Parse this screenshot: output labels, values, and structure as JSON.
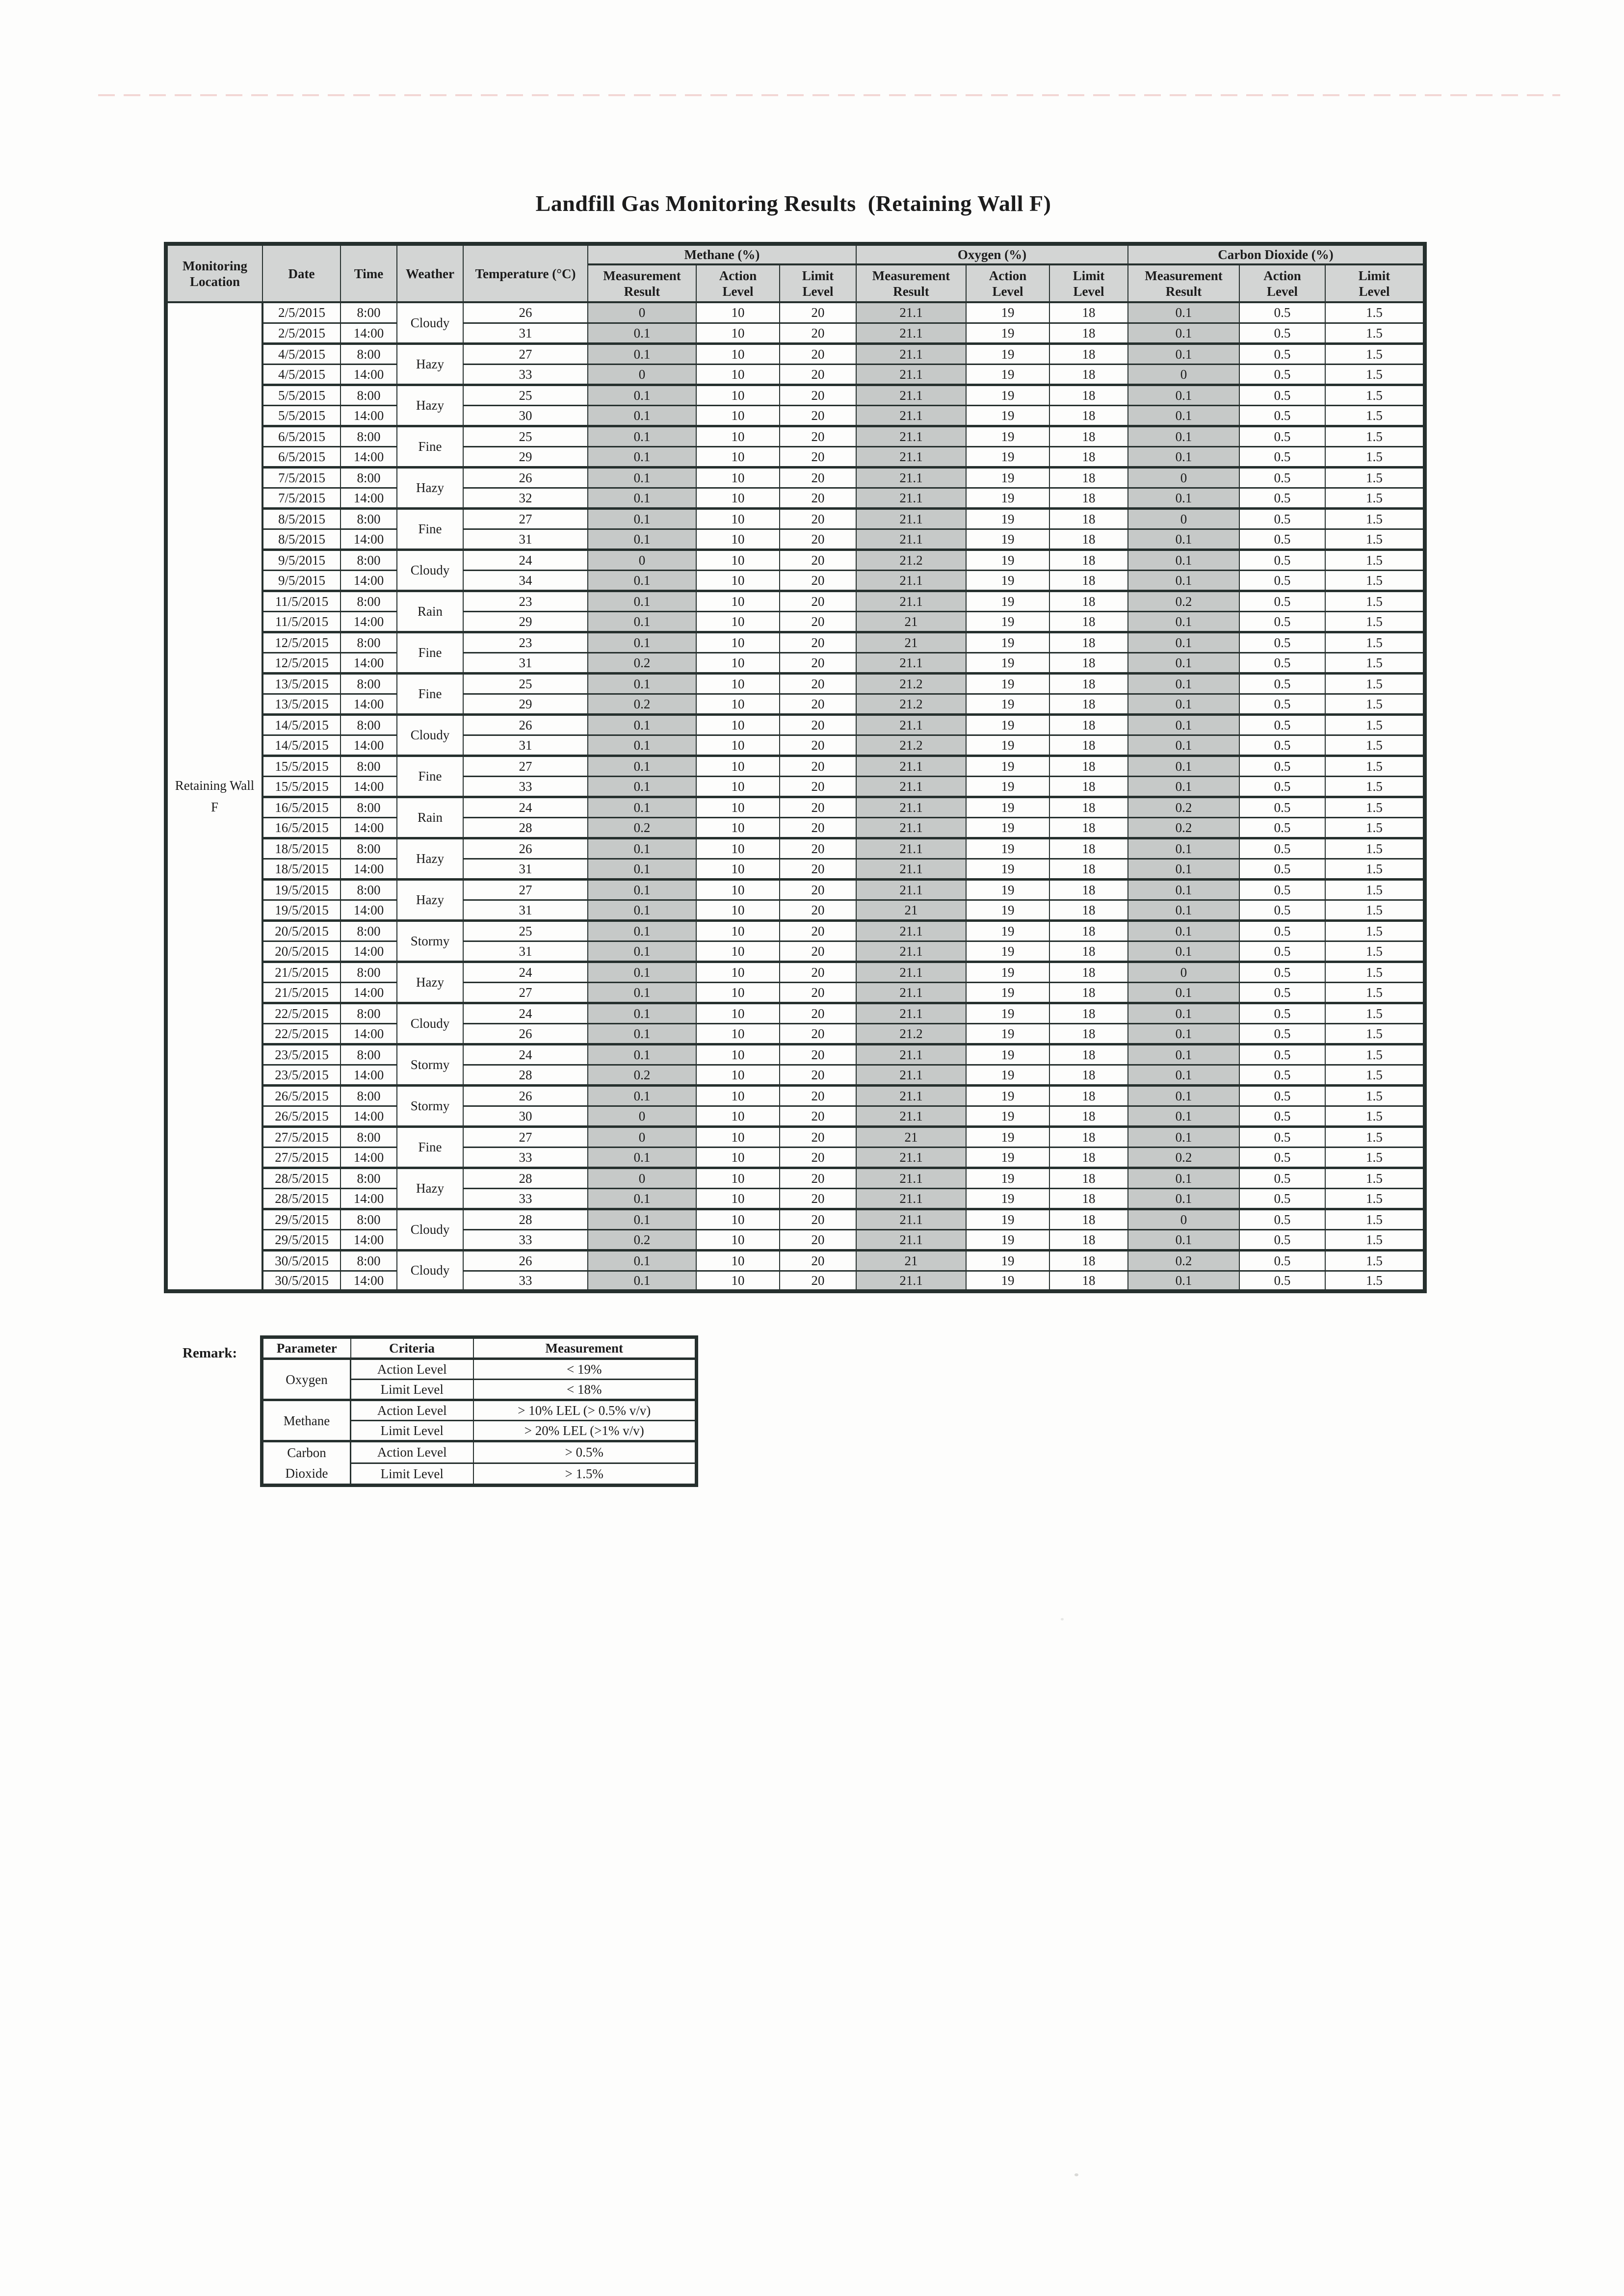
{
  "page": {
    "title": "Landfill Gas Monitoring Results  (Retaining Wall F)"
  },
  "colors": {
    "paper": "#fdfdfc",
    "ink": "#1c1c1c",
    "line": "#26302e",
    "cell_shade": "#c6c9c8",
    "header_shade": "#d3d5d4"
  },
  "table": {
    "location_label": "Retaining Wall\nF",
    "headers": {
      "location": "Monitoring\nLocation",
      "date": "Date",
      "time": "Time",
      "weather": "Weather",
      "temperature": "Temperature (°C)",
      "methane_group": "Methane (%)",
      "oxygen_group": "Oxygen (%)",
      "co2_group": "Carbon Dioxide (%)",
      "sub": [
        "Measurement\nResult",
        "Action\nLevel",
        "Limit\nLevel"
      ]
    },
    "constants": {
      "methane_action": "10",
      "methane_limit": "20",
      "oxygen_action": "19",
      "oxygen_limit": "18",
      "co2_action": "0.5",
      "co2_limit": "1.5"
    },
    "days": [
      {
        "date": "2/5/2015",
        "weather": "Cloudy",
        "entries": [
          {
            "time": "8:00",
            "temp": "26",
            "ch4": "0",
            "o2": "21.1",
            "co2": "0.1"
          },
          {
            "time": "14:00",
            "temp": "31",
            "ch4": "0.1",
            "o2": "21.1",
            "co2": "0.1"
          }
        ]
      },
      {
        "date": "4/5/2015",
        "weather": "Hazy",
        "entries": [
          {
            "time": "8:00",
            "temp": "27",
            "ch4": "0.1",
            "o2": "21.1",
            "co2": "0.1"
          },
          {
            "time": "14:00",
            "temp": "33",
            "ch4": "0",
            "o2": "21.1",
            "co2": "0"
          }
        ]
      },
      {
        "date": "5/5/2015",
        "weather": "Hazy",
        "entries": [
          {
            "time": "8:00",
            "temp": "25",
            "ch4": "0.1",
            "o2": "21.1",
            "co2": "0.1"
          },
          {
            "time": "14:00",
            "temp": "30",
            "ch4": "0.1",
            "o2": "21.1",
            "co2": "0.1"
          }
        ]
      },
      {
        "date": "6/5/2015",
        "weather": "Fine",
        "entries": [
          {
            "time": "8:00",
            "temp": "25",
            "ch4": "0.1",
            "o2": "21.1",
            "co2": "0.1"
          },
          {
            "time": "14:00",
            "temp": "29",
            "ch4": "0.1",
            "o2": "21.1",
            "co2": "0.1"
          }
        ]
      },
      {
        "date": "7/5/2015",
        "weather": "Hazy",
        "entries": [
          {
            "time": "8:00",
            "temp": "26",
            "ch4": "0.1",
            "o2": "21.1",
            "co2": "0"
          },
          {
            "time": "14:00",
            "temp": "32",
            "ch4": "0.1",
            "o2": "21.1",
            "co2": "0.1"
          }
        ]
      },
      {
        "date": "8/5/2015",
        "weather": "Fine",
        "entries": [
          {
            "time": "8:00",
            "temp": "27",
            "ch4": "0.1",
            "o2": "21.1",
            "co2": "0"
          },
          {
            "time": "14:00",
            "temp": "31",
            "ch4": "0.1",
            "o2": "21.1",
            "co2": "0.1"
          }
        ]
      },
      {
        "date": "9/5/2015",
        "weather": "Cloudy",
        "entries": [
          {
            "time": "8:00",
            "temp": "24",
            "ch4": "0",
            "o2": "21.2",
            "co2": "0.1"
          },
          {
            "time": "14:00",
            "temp": "34",
            "ch4": "0.1",
            "o2": "21.1",
            "co2": "0.1"
          }
        ]
      },
      {
        "date": "11/5/2015",
        "weather": "Rain",
        "entries": [
          {
            "time": "8:00",
            "temp": "23",
            "ch4": "0.1",
            "o2": "21.1",
            "co2": "0.2"
          },
          {
            "time": "14:00",
            "temp": "29",
            "ch4": "0.1",
            "o2": "21",
            "co2": "0.1"
          }
        ]
      },
      {
        "date": "12/5/2015",
        "weather": "Fine",
        "entries": [
          {
            "time": "8:00",
            "temp": "23",
            "ch4": "0.1",
            "o2": "21",
            "co2": "0.1"
          },
          {
            "time": "14:00",
            "temp": "31",
            "ch4": "0.2",
            "o2": "21.1",
            "co2": "0.1"
          }
        ]
      },
      {
        "date": "13/5/2015",
        "weather": "Fine",
        "entries": [
          {
            "time": "8:00",
            "temp": "25",
            "ch4": "0.1",
            "o2": "21.2",
            "co2": "0.1"
          },
          {
            "time": "14:00",
            "temp": "29",
            "ch4": "0.2",
            "o2": "21.2",
            "co2": "0.1"
          }
        ]
      },
      {
        "date": "14/5/2015",
        "weather": "Cloudy",
        "entries": [
          {
            "time": "8:00",
            "temp": "26",
            "ch4": "0.1",
            "o2": "21.1",
            "co2": "0.1"
          },
          {
            "time": "14:00",
            "temp": "31",
            "ch4": "0.1",
            "o2": "21.2",
            "co2": "0.1"
          }
        ]
      },
      {
        "date": "15/5/2015",
        "weather": "Fine",
        "entries": [
          {
            "time": "8:00",
            "temp": "27",
            "ch4": "0.1",
            "o2": "21.1",
            "co2": "0.1"
          },
          {
            "time": "14:00",
            "temp": "33",
            "ch4": "0.1",
            "o2": "21.1",
            "co2": "0.1"
          }
        ]
      },
      {
        "date": "16/5/2015",
        "weather": "Rain",
        "entries": [
          {
            "time": "8:00",
            "temp": "24",
            "ch4": "0.1",
            "o2": "21.1",
            "co2": "0.2"
          },
          {
            "time": "14:00",
            "temp": "28",
            "ch4": "0.2",
            "o2": "21.1",
            "co2": "0.2"
          }
        ]
      },
      {
        "date": "18/5/2015",
        "weather": "Hazy",
        "entries": [
          {
            "time": "8:00",
            "temp": "26",
            "ch4": "0.1",
            "o2": "21.1",
            "co2": "0.1"
          },
          {
            "time": "14:00",
            "temp": "31",
            "ch4": "0.1",
            "o2": "21.1",
            "co2": "0.1"
          }
        ]
      },
      {
        "date": "19/5/2015",
        "weather": "Hazy",
        "entries": [
          {
            "time": "8:00",
            "temp": "27",
            "ch4": "0.1",
            "o2": "21.1",
            "co2": "0.1"
          },
          {
            "time": "14:00",
            "temp": "31",
            "ch4": "0.1",
            "o2": "21",
            "co2": "0.1"
          }
        ]
      },
      {
        "date": "20/5/2015",
        "weather": "Stormy",
        "entries": [
          {
            "time": "8:00",
            "temp": "25",
            "ch4": "0.1",
            "o2": "21.1",
            "co2": "0.1"
          },
          {
            "time": "14:00",
            "temp": "31",
            "ch4": "0.1",
            "o2": "21.1",
            "co2": "0.1"
          }
        ]
      },
      {
        "date": "21/5/2015",
        "weather": "Hazy",
        "entries": [
          {
            "time": "8:00",
            "temp": "24",
            "ch4": "0.1",
            "o2": "21.1",
            "co2": "0"
          },
          {
            "time": "14:00",
            "temp": "27",
            "ch4": "0.1",
            "o2": "21.1",
            "co2": "0.1"
          }
        ]
      },
      {
        "date": "22/5/2015",
        "weather": "Cloudy",
        "entries": [
          {
            "time": "8:00",
            "temp": "24",
            "ch4": "0.1",
            "o2": "21.1",
            "co2": "0.1"
          },
          {
            "time": "14:00",
            "temp": "26",
            "ch4": "0.1",
            "o2": "21.2",
            "co2": "0.1"
          }
        ]
      },
      {
        "date": "23/5/2015",
        "weather": "Stormy",
        "entries": [
          {
            "time": "8:00",
            "temp": "24",
            "ch4": "0.1",
            "o2": "21.1",
            "co2": "0.1"
          },
          {
            "time": "14:00",
            "temp": "28",
            "ch4": "0.2",
            "o2": "21.1",
            "co2": "0.1"
          }
        ]
      },
      {
        "date": "26/5/2015",
        "weather": "Stormy",
        "entries": [
          {
            "time": "8:00",
            "temp": "26",
            "ch4": "0.1",
            "o2": "21.1",
            "co2": "0.1"
          },
          {
            "time": "14:00",
            "temp": "30",
            "ch4": "0",
            "o2": "21.1",
            "co2": "0.1"
          }
        ]
      },
      {
        "date": "27/5/2015",
        "weather": "Fine",
        "entries": [
          {
            "time": "8:00",
            "temp": "27",
            "ch4": "0",
            "o2": "21",
            "co2": "0.1"
          },
          {
            "time": "14:00",
            "temp": "33",
            "ch4": "0.1",
            "o2": "21.1",
            "co2": "0.2"
          }
        ]
      },
      {
        "date": "28/5/2015",
        "weather": "Hazy",
        "entries": [
          {
            "time": "8:00",
            "temp": "28",
            "ch4": "0",
            "o2": "21.1",
            "co2": "0.1"
          },
          {
            "time": "14:00",
            "temp": "33",
            "ch4": "0.1",
            "o2": "21.1",
            "co2": "0.1"
          }
        ]
      },
      {
        "date": "29/5/2015",
        "weather": "Cloudy",
        "entries": [
          {
            "time": "8:00",
            "temp": "28",
            "ch4": "0.1",
            "o2": "21.1",
            "co2": "0"
          },
          {
            "time": "14:00",
            "temp": "33",
            "ch4": "0.2",
            "o2": "21.1",
            "co2": "0.1"
          }
        ]
      },
      {
        "date": "30/5/2015",
        "weather": "Cloudy",
        "entries": [
          {
            "time": "8:00",
            "temp": "26",
            "ch4": "0.1",
            "o2": "21",
            "co2": "0.2"
          },
          {
            "time": "14:00",
            "temp": "33",
            "ch4": "0.1",
            "o2": "21.1",
            "co2": "0.1"
          }
        ]
      }
    ]
  },
  "remark": {
    "label": "Remark:",
    "headers": {
      "parameter": "Parameter",
      "criteria": "Criteria",
      "measurement": "Measurement"
    },
    "groups": [
      {
        "name": "Oxygen",
        "rows": [
          {
            "criteria": "Action Level",
            "measurement": "< 19%"
          },
          {
            "criteria": "Limit Level",
            "measurement": "< 18%"
          }
        ]
      },
      {
        "name": "Methane",
        "rows": [
          {
            "criteria": "Action Level",
            "measurement": "> 10% LEL (> 0.5% v/v)"
          },
          {
            "criteria": "Limit Level",
            "measurement": "> 20% LEL (>1% v/v)"
          }
        ]
      },
      {
        "name": "Carbon\nDioxide",
        "rows": [
          {
            "criteria": "Action Level",
            "measurement": "> 0.5%"
          },
          {
            "criteria": "Limit Level",
            "measurement": "> 1.5%"
          }
        ]
      }
    ]
  }
}
